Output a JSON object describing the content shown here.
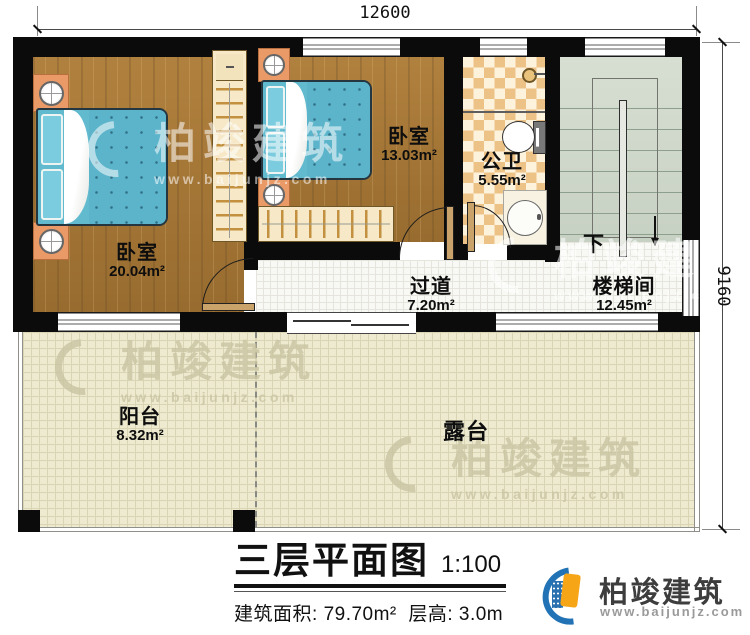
{
  "dimensions": {
    "width_mm": "12600",
    "height_mm": "9160"
  },
  "rooms": {
    "bedroom1": {
      "label": "卧室",
      "area": "20.04m²"
    },
    "bedroom2": {
      "label": "卧室",
      "area": "13.03m²"
    },
    "bathroom": {
      "label": "公卫",
      "area": "5.55m²"
    },
    "corridor": {
      "label": "过道",
      "area": "7.20m²"
    },
    "stairwell": {
      "label": "楼梯间",
      "area": "12.45m²"
    },
    "balcony": {
      "label": "阳台",
      "area": "8.32m²"
    },
    "terrace": {
      "label": "露台"
    }
  },
  "stairs": {
    "direction_label": "下"
  },
  "title_block": {
    "title": "三层平面图",
    "scale": "1:100",
    "area_label": "建筑面积: ",
    "area_value": "79.70m²",
    "floor_height_label": "  层高: ",
    "floor_height_value": "3.0m"
  },
  "brand": {
    "name": "柏竣建筑",
    "website": "www.baijunjz.com"
  },
  "watermark": {
    "name": "柏竣建筑",
    "website": "www.baijunjz.com"
  },
  "colors": {
    "wall": "#0b0b0b",
    "wood_floor": "#a97a38",
    "bed": "#62bacf",
    "bathroom_tile": "#edc287",
    "stair_floor": "#ccd6c8",
    "patio_floor": "#edead0",
    "brand_blue": "#2173b5",
    "brand_orange": "#f6a517"
  }
}
